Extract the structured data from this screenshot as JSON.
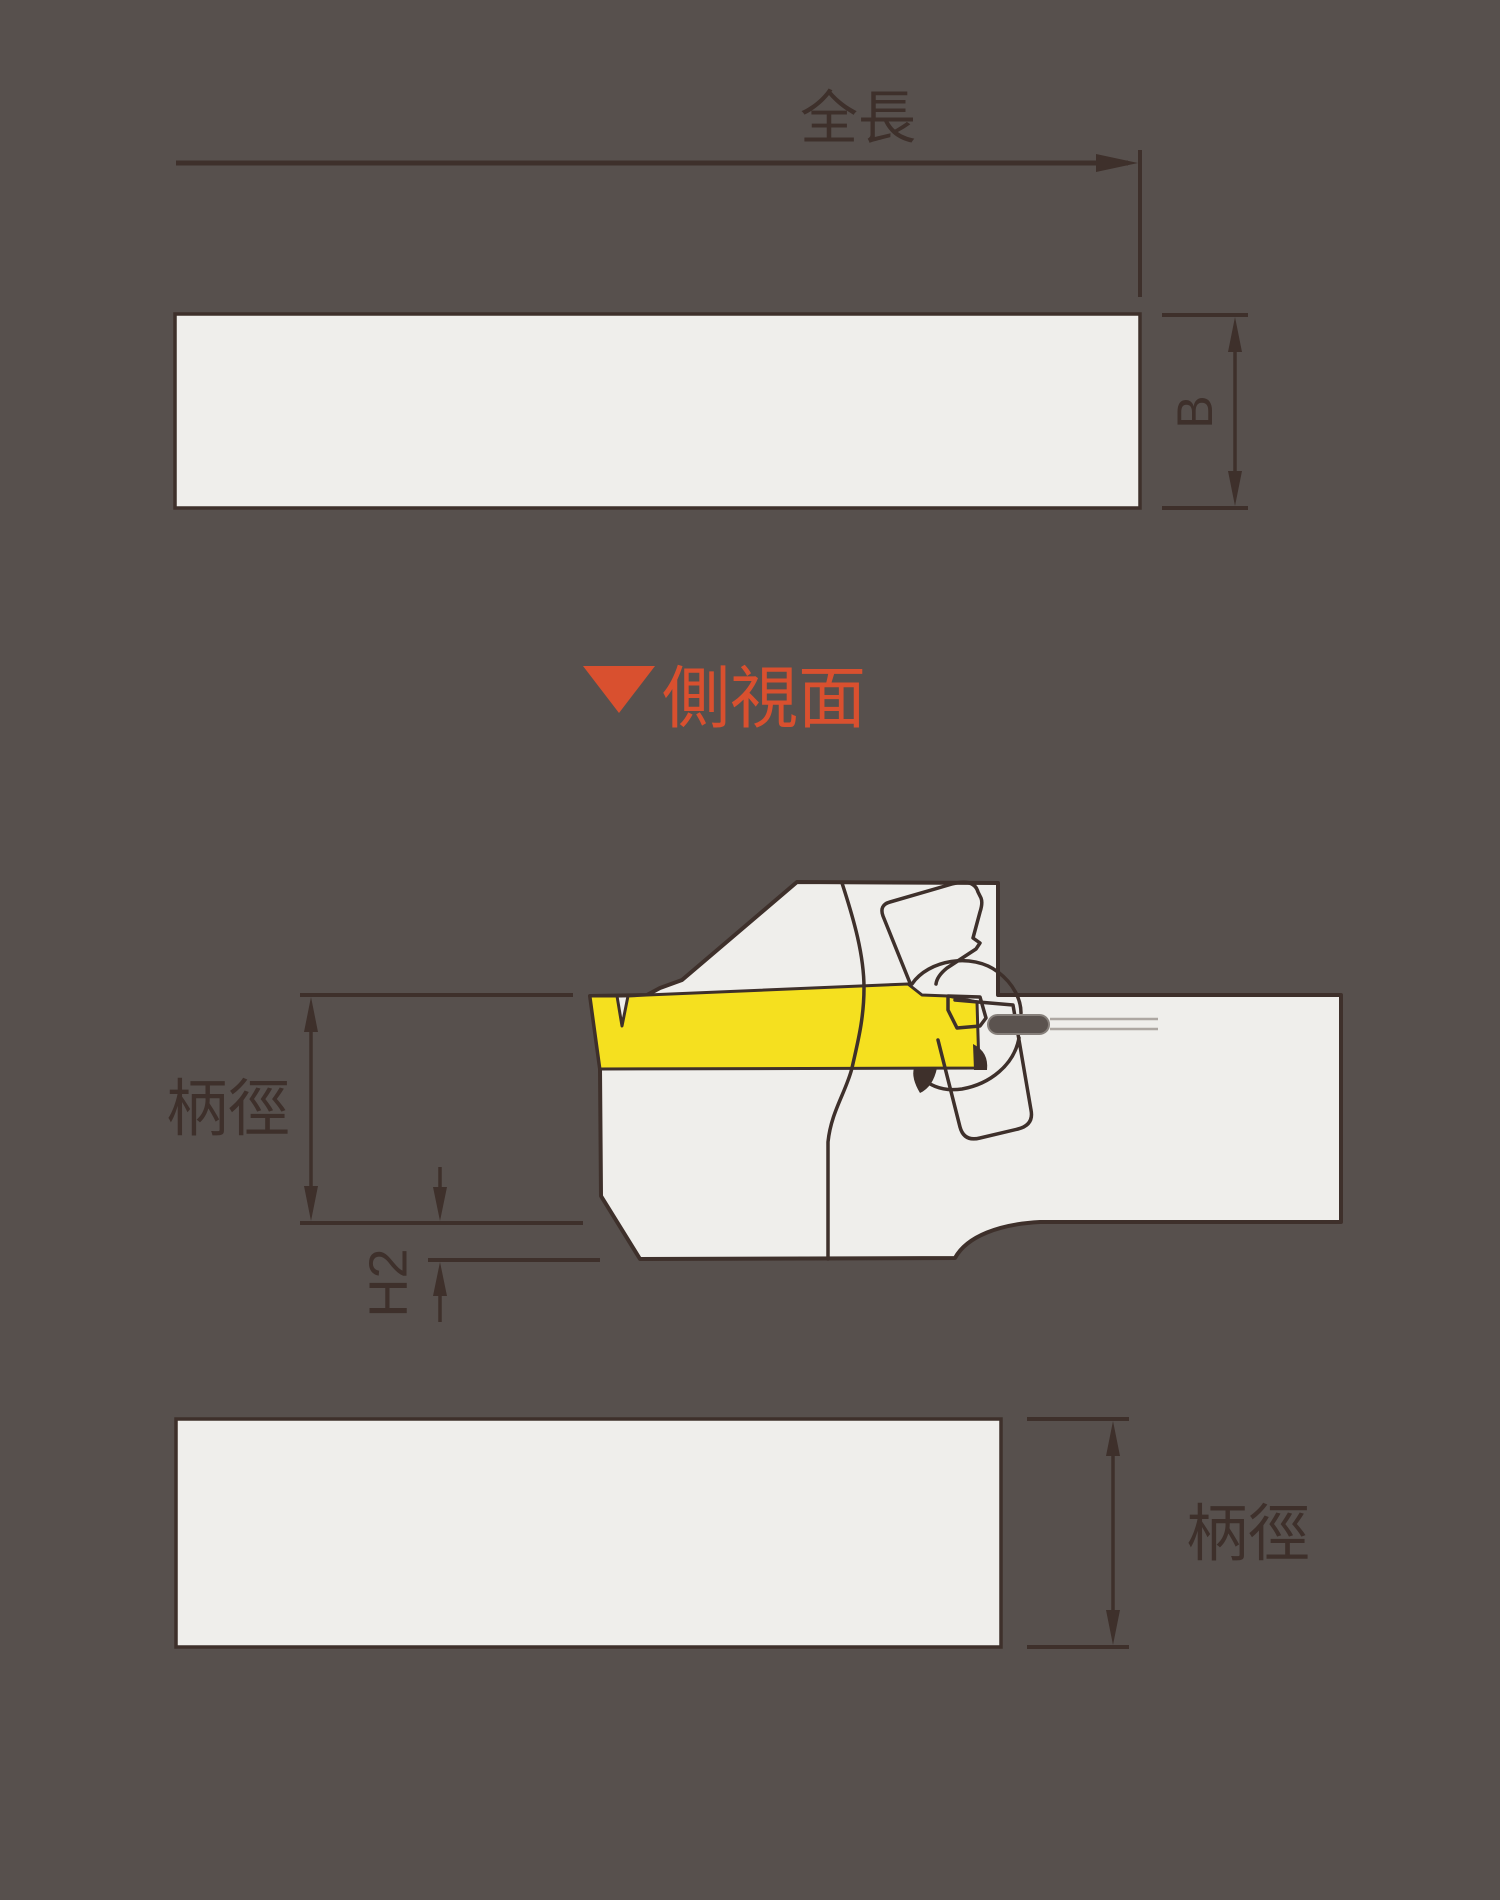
{
  "drawing": {
    "type": "tool-holder-dimension-diagram",
    "colors": {
      "background": "#57504D",
      "body_fill": "#EFEEEB",
      "outline": "#3E302B",
      "insert_yellow": "#F5E01F",
      "accent_red": "#D9502F",
      "pin_fill": "#5B534F",
      "hidden_line_gray": "#ADA7A2"
    },
    "top_view": {
      "length_label": "全長",
      "width_label": "B"
    },
    "side_view": {
      "marker_label": "側視面",
      "marker_icon": "down-triangle-icon",
      "shank_label": "柄徑",
      "offset_label": "H2"
    },
    "bottom_view": {
      "shank_label": "柄徑"
    }
  }
}
